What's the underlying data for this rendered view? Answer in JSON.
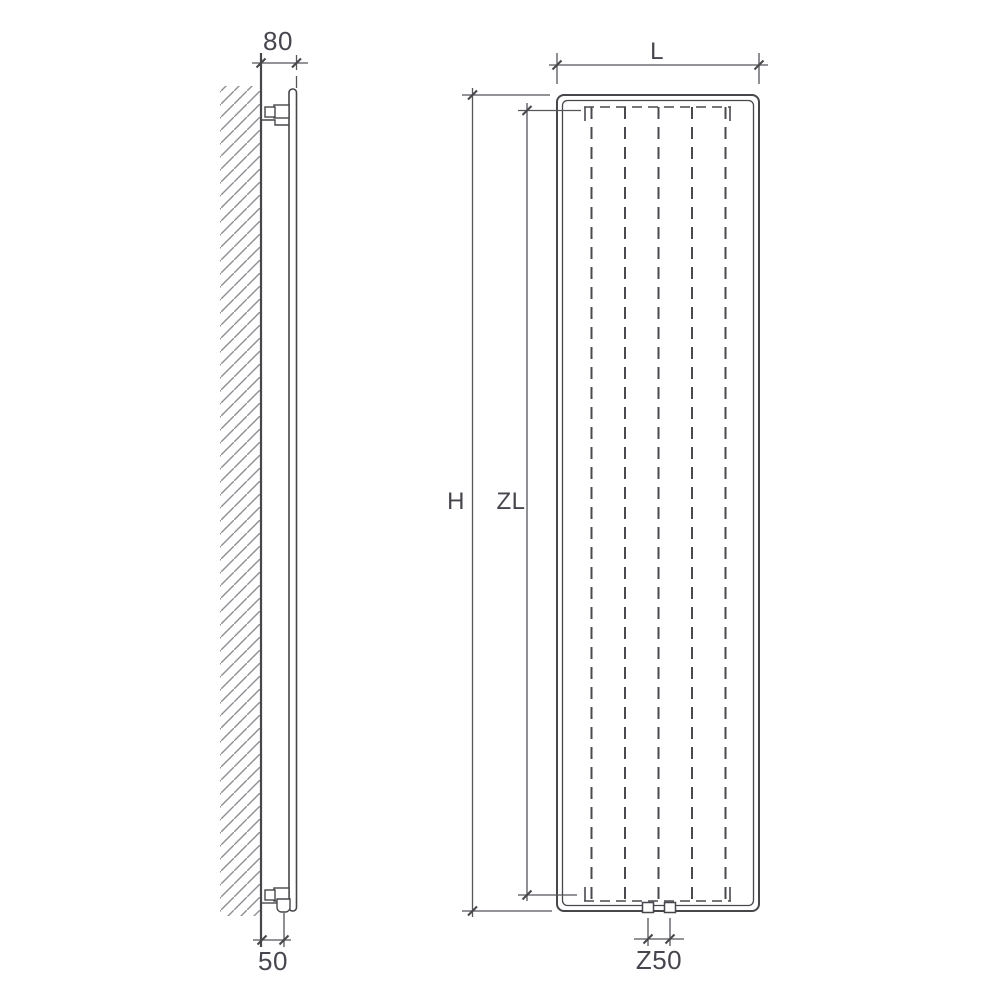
{
  "diagram": {
    "kind": "radiator-dimension-drawing",
    "side_view": {
      "depth_dimension_label": "80",
      "connection_offset_label": "50"
    },
    "front_view": {
      "width_dimension_label": "L",
      "height_dimension_label": "H",
      "axial_length_dimension_label": "ZL",
      "connection_spacing_label": "Z50"
    }
  },
  "colors": {
    "background": "#ffffff",
    "outline": "#47474b",
    "dimension_line": "#55555a",
    "hatch": "#8f8f94",
    "label_text": "#46464e"
  }
}
